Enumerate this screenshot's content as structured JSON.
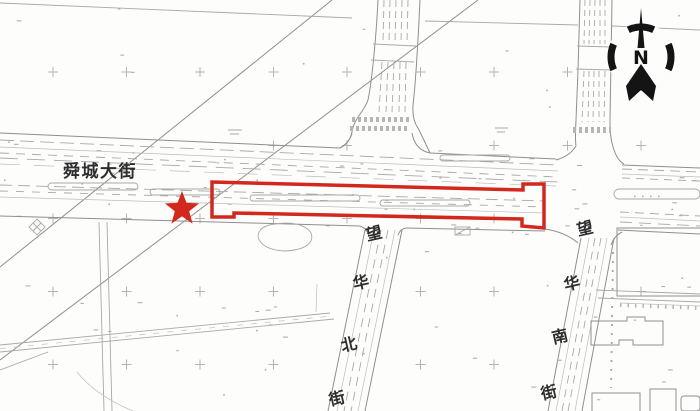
{
  "map": {
    "labels": {
      "main_street": "舜城大街",
      "north_street": "望华北街",
      "north_street_chars": [
        "望",
        "华",
        "北",
        "街"
      ],
      "south_street": "望华南街",
      "south_street_chars": [
        "望",
        "华",
        "南",
        "街"
      ]
    },
    "compass": {
      "letter": "N"
    },
    "colors": {
      "highlight": "#d2281e",
      "line_light": "#b4b4b4",
      "line_mid": "#9a9a9a",
      "label": "#2d2d2d",
      "background": "#fdfdfc"
    }
  }
}
